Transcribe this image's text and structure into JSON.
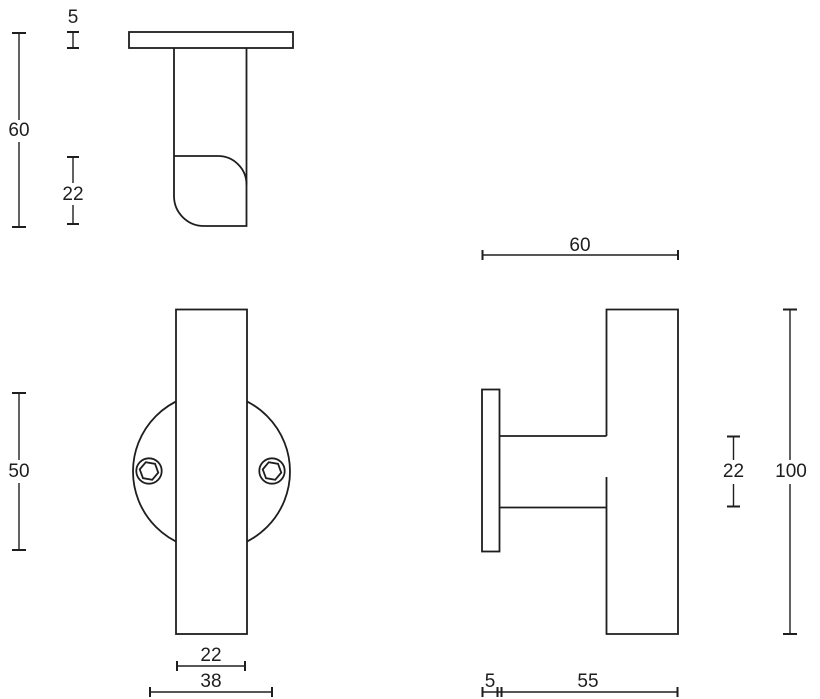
{
  "canvas": {
    "background": "#ffffff",
    "line_color": "#1e1e1e",
    "text_color": "#1e1e1e"
  },
  "dimensions": {
    "top_view": {
      "plate_thickness": "5",
      "total_depth": "60",
      "knob_depth": "22"
    },
    "front_view": {
      "rose_diameter": "50",
      "bar_width": "22",
      "screw_spacing": "38"
    },
    "side_view": {
      "total_depth": "60",
      "stem_diameter": "22",
      "bar_length": "100",
      "plate_thickness": "5",
      "projection": "55"
    }
  }
}
